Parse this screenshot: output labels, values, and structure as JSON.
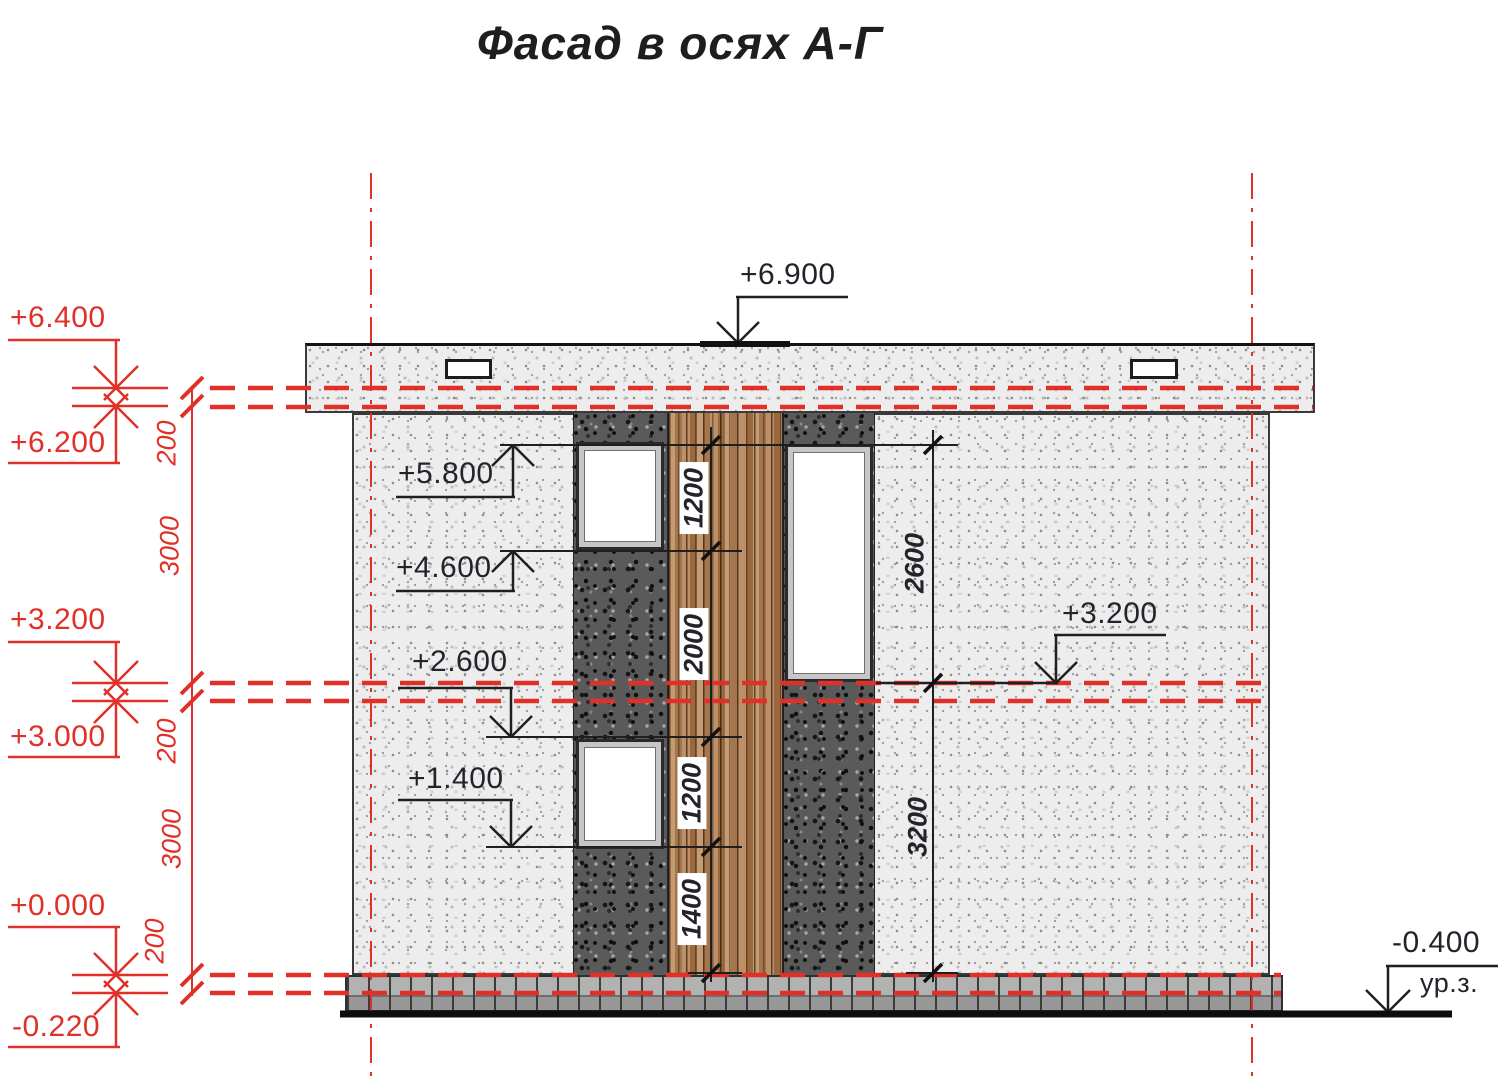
{
  "title": "Фасад в осях А-Г",
  "colors": {
    "red_accent": "#e03028",
    "line_black": "#1f1f1f",
    "wood": "#b78660"
  },
  "levels_left": [
    {
      "label": "+6.400"
    },
    {
      "label": "+6.200"
    },
    {
      "label": "+3.200"
    },
    {
      "label": "+3.000"
    },
    {
      "label": "+0.000"
    },
    {
      "label": "-0.220"
    }
  ],
  "levels_black": {
    "roof": "+6.900",
    "window1_top": "+5.800",
    "window1_bottom": "+4.600",
    "window2_top": "+2.600",
    "window2_bottom": "+1.400",
    "right_floor": "+3.200",
    "ground": "-0.400"
  },
  "ground_level_label": "ур.з.",
  "dim_chain_left": [
    "200",
    "3000",
    "200",
    "3000",
    "200"
  ],
  "dim_chain_center": [
    "1200",
    "2000",
    "1200",
    "1400"
  ],
  "dim_chain_right": [
    "2600",
    "3200"
  ]
}
